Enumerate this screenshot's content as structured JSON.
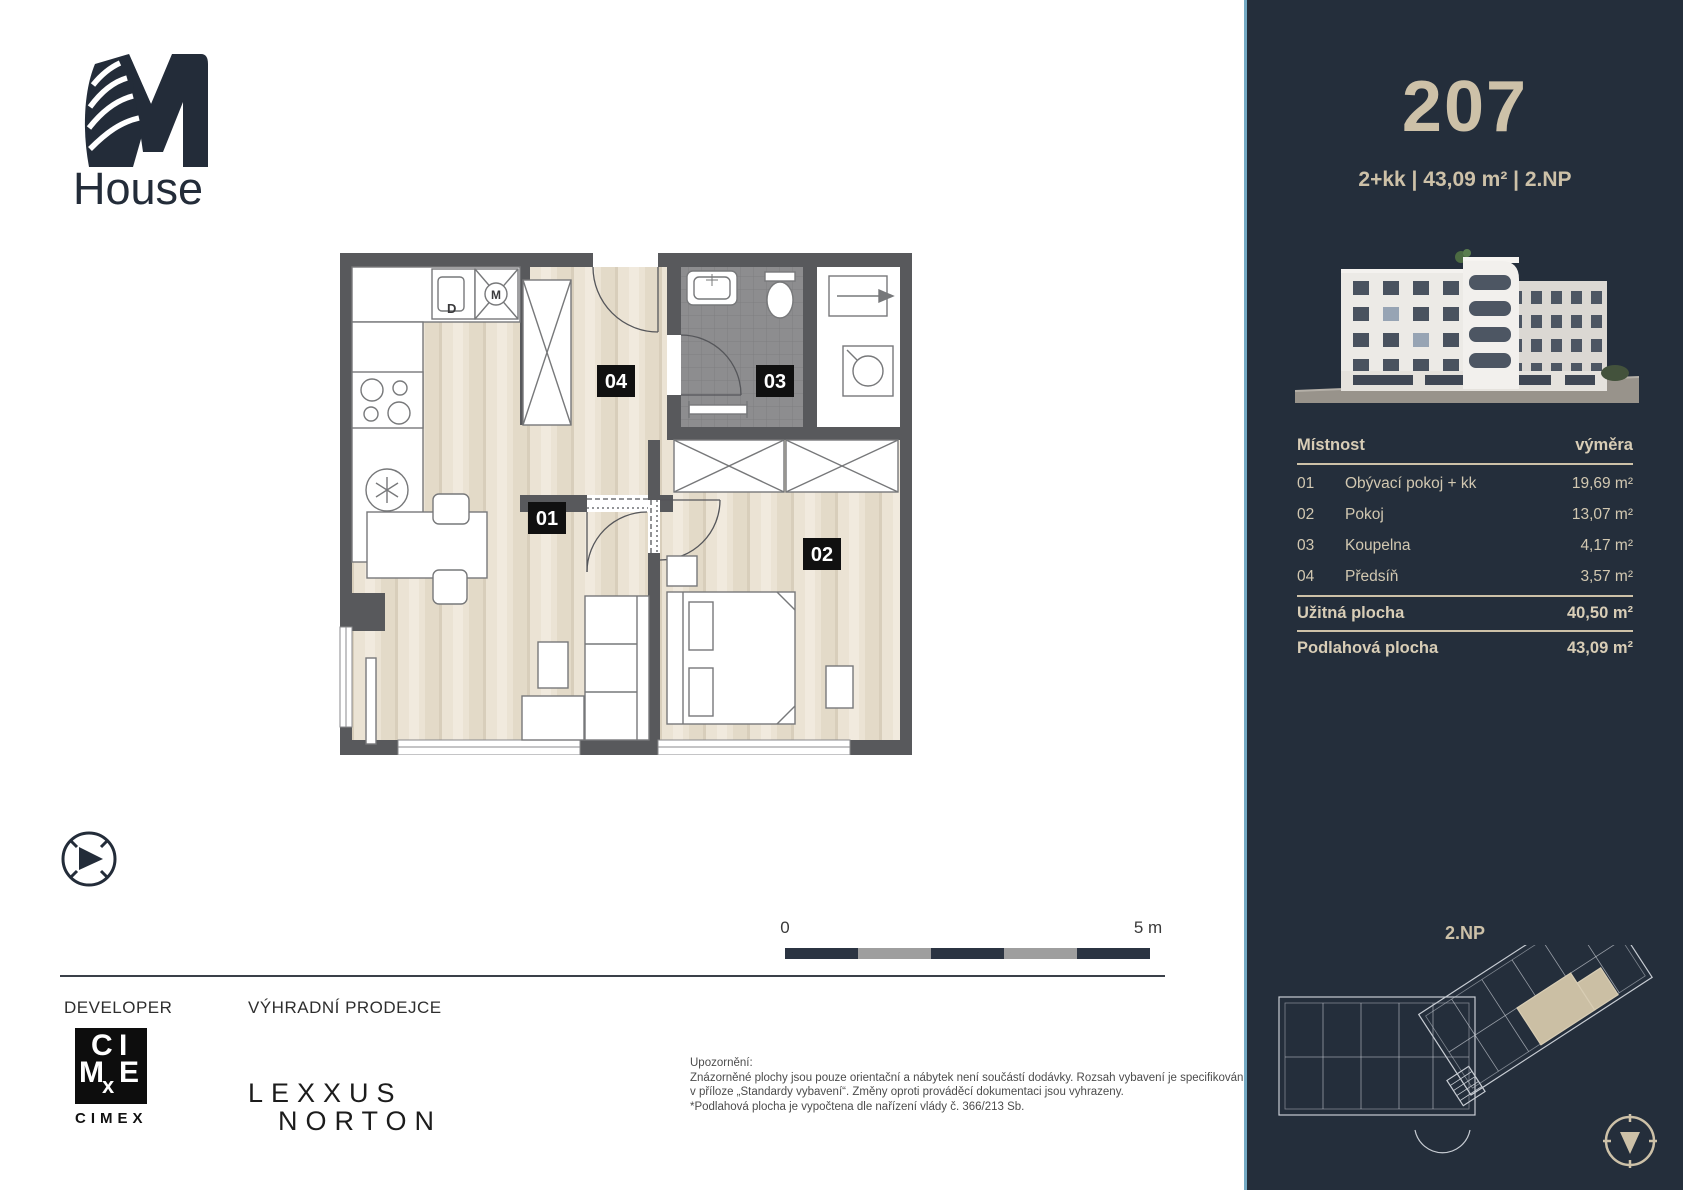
{
  "brand": {
    "name": "House"
  },
  "sidebar": {
    "unit_number": "207",
    "unit_specs": "2+kk | 43,09 m² | 2.NP",
    "table": {
      "header": {
        "room": "Místnost",
        "area": "výměra"
      },
      "rows": [
        {
          "num": "01",
          "name": "Obývací pokoj + kk",
          "area": "19,69 m²"
        },
        {
          "num": "02",
          "name": "Pokoj",
          "area": "13,07 m²"
        },
        {
          "num": "03",
          "name": "Koupelna",
          "area": "4,17 m²"
        },
        {
          "num": "04",
          "name": "Předsíň",
          "area": "3,57 m²"
        }
      ],
      "totals": [
        {
          "label": "Užitná plocha",
          "value": "40,50 m²"
        },
        {
          "label": "Podlahová plocha",
          "value": "43,09 m²"
        }
      ]
    },
    "floor_plan_label": "2.NP"
  },
  "plan": {
    "room_labels": {
      "r01": "01",
      "r02": "02",
      "r03": "03",
      "r04": "04"
    },
    "appliances": {
      "dishwasher": "D",
      "washer": "M"
    },
    "scale": {
      "start": "0",
      "end": "5 m"
    }
  },
  "footer": {
    "developer_label": "DEVELOPER",
    "seller_label": "VÝHRADNÍ PRODEJCE",
    "cimex_letters": {
      "c": "C",
      "i": "I",
      "m": "M",
      "e": "E",
      "x": "x"
    },
    "cimex_wordmark": "CIMEX",
    "lexxus_line1": "LEXXUS",
    "lexxus_line2": "NORTON",
    "disclaimer_title": "Upozornění:",
    "disclaimer_lines": [
      "Znázorněné plochy jsou pouze orientační a nábytek není součástí dodávky. Rozsah vybavení je specifikován",
      "v příloze „Standardy vybavení“. Změny oproti prováděcí dokumentaci jsou vyhrazeny.",
      "*Podlahová plocha je vypočtena dle nařízení vlády č. 366/213 Sb."
    ]
  },
  "colors": {
    "sidebar_bg": "#242e3b",
    "accent_beige": "#cdc1a8",
    "edge_blue": "#74aac4",
    "wall_gray": "#58595c",
    "bath_gray": "#8d8d8f",
    "wood_floor": "#ebe3d4",
    "label_black": "#101010"
  }
}
